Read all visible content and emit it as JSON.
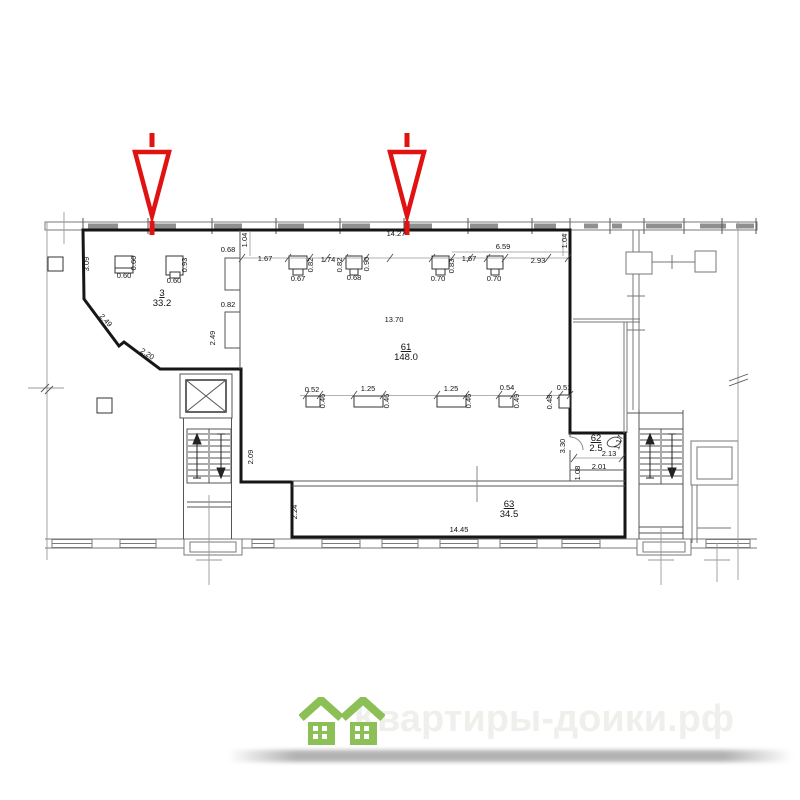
{
  "watermark": {
    "text_left": "Квартиры-до",
    "text_right": "ики.рф",
    "houses_icon": "green-houses-icon",
    "bar_color": "#696969",
    "house_color": "#8dbf57"
  },
  "plan": {
    "rooms": [
      {
        "number": "3",
        "area": "33.2",
        "x": 162,
        "y": 296
      },
      {
        "number": "61",
        "area": "148.0",
        "x": 406,
        "y": 350
      },
      {
        "number": "62",
        "area": "2.5",
        "x": 596,
        "y": 441
      },
      {
        "number": "63",
        "area": "34.5",
        "x": 509,
        "y": 507
      }
    ],
    "dims": [
      {
        "t": "3.09",
        "x": 89,
        "y": 264,
        "r": -90
      },
      {
        "t": "0.60",
        "x": 136,
        "y": 263,
        "r": -90
      },
      {
        "t": "0.60",
        "x": 124,
        "y": 278,
        "r": 0
      },
      {
        "t": "0.93",
        "x": 187,
        "y": 265,
        "r": -90
      },
      {
        "t": "0.60",
        "x": 174,
        "y": 283,
        "r": 0
      },
      {
        "t": "2.49",
        "x": 104,
        "y": 322,
        "r": 47
      },
      {
        "t": "2.20",
        "x": 146,
        "y": 356,
        "r": 33
      },
      {
        "t": "0.68",
        "x": 228,
        "y": 252,
        "r": 0
      },
      {
        "t": "0.82",
        "x": 228,
        "y": 307,
        "r": 0
      },
      {
        "t": "2.49",
        "x": 215,
        "y": 338,
        "r": -90
      },
      {
        "t": "1.04",
        "x": 247,
        "y": 240,
        "r": -90
      },
      {
        "t": "14.27",
        "x": 396,
        "y": 236,
        "r": 0
      },
      {
        "t": "1.67",
        "x": 265,
        "y": 261,
        "r": 0
      },
      {
        "t": "0.82",
        "x": 313,
        "y": 265,
        "r": -90
      },
      {
        "t": "1.74",
        "x": 328,
        "y": 262,
        "r": 0
      },
      {
        "t": "0.82",
        "x": 342,
        "y": 265,
        "r": -90
      },
      {
        "t": "0.90",
        "x": 369,
        "y": 264,
        "r": -90
      },
      {
        "t": "0.67",
        "x": 298,
        "y": 281,
        "r": 0
      },
      {
        "t": "0.68",
        "x": 354,
        "y": 280,
        "r": 0
      },
      {
        "t": "0.83",
        "x": 454,
        "y": 266,
        "r": -90
      },
      {
        "t": "1.67",
        "x": 469,
        "y": 261,
        "r": 0
      },
      {
        "t": "2.93",
        "x": 538,
        "y": 263,
        "r": 0
      },
      {
        "t": "0.70",
        "x": 438,
        "y": 281,
        "r": 0
      },
      {
        "t": "0.70",
        "x": 494,
        "y": 281,
        "r": 0
      },
      {
        "t": "6.59",
        "x": 503,
        "y": 249,
        "r": 0
      },
      {
        "t": "1.04",
        "x": 567,
        "y": 241,
        "r": -90
      },
      {
        "t": "13.70",
        "x": 394,
        "y": 322,
        "r": 0
      },
      {
        "t": "0.52",
        "x": 312,
        "y": 392,
        "r": 0
      },
      {
        "t": "0.46",
        "x": 325,
        "y": 401,
        "r": -90
      },
      {
        "t": "1.25",
        "x": 368,
        "y": 391,
        "r": 0
      },
      {
        "t": "0.46",
        "x": 389,
        "y": 401,
        "r": -90
      },
      {
        "t": "1.25",
        "x": 451,
        "y": 391,
        "r": 0
      },
      {
        "t": "0.46",
        "x": 471,
        "y": 401,
        "r": -90
      },
      {
        "t": "0.54",
        "x": 507,
        "y": 390,
        "r": 0
      },
      {
        "t": "0.49",
        "x": 519,
        "y": 401,
        "r": -90
      },
      {
        "t": "0.48",
        "x": 552,
        "y": 402,
        "r": -90
      },
      {
        "t": "0.51",
        "x": 564,
        "y": 390,
        "r": 0
      },
      {
        "t": "2.09",
        "x": 253,
        "y": 457,
        "r": -90
      },
      {
        "t": "2.24",
        "x": 297,
        "y": 512,
        "r": -90
      },
      {
        "t": "3.30",
        "x": 565,
        "y": 446,
        "r": -90
      },
      {
        "t": "1.17",
        "x": 621,
        "y": 443,
        "r": -72
      },
      {
        "t": "2.13",
        "x": 609,
        "y": 456,
        "r": 0
      },
      {
        "t": "2.01",
        "x": 599,
        "y": 469,
        "r": 0
      },
      {
        "t": "1.08",
        "x": 580,
        "y": 473,
        "r": -90
      },
      {
        "t": "14.45",
        "x": 459,
        "y": 532,
        "r": 0
      }
    ],
    "entrance_arrows": [
      {
        "x": 152
      },
      {
        "x": 407
      }
    ],
    "colors": {
      "room_label": "#2f2f9e",
      "dimension_text": "#111111",
      "arrow": "#e01212"
    }
  }
}
